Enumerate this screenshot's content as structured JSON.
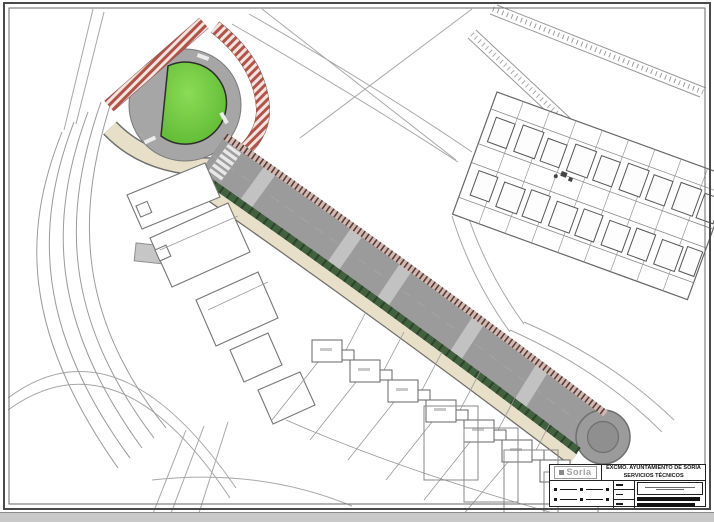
{
  "plan": {
    "title_block": {
      "logo_text": "Soria",
      "org_line1": "EXCMO. AYUNTAMIENTO DE SORIA",
      "org_line2": "SERVICIOS TÉCNICOS"
    },
    "colors": {
      "paper_white": "#ffffff",
      "frame_dark": "#4a4a4a",
      "cad_line_gray": "#9a9a9a",
      "road_gray": "#9b9b9b",
      "road_edge_gray": "#6f6f6f",
      "crosswalk_gray": "#c2c2c2",
      "island_green_light": "#8bdb55",
      "island_green": "#5cb832",
      "landscape_green": "#40603e",
      "sidewalk_beige": "#e8dfc8",
      "hatch_red": "#b0544a",
      "hatch_pink": "#f3e4e0",
      "hatch_tick_brown": "#5d3a35",
      "turnaround_gray": "#8f8f8f",
      "scan_band_gray": "#c9c9c9"
    }
  }
}
